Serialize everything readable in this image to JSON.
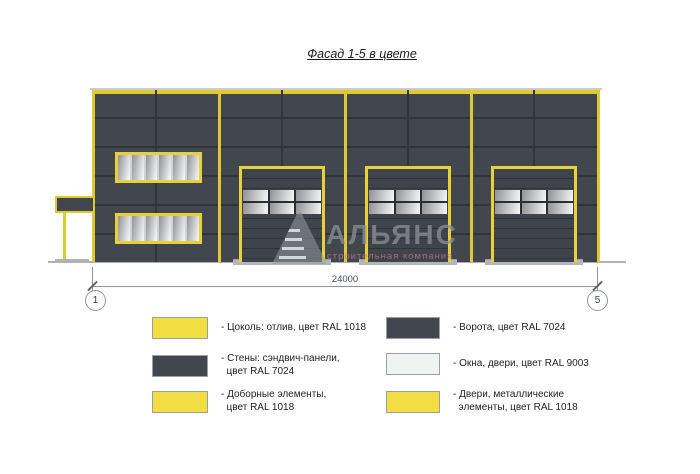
{
  "title": "Фасад 1-5 в цвете",
  "watermark": {
    "name": "АЛЬЯНС",
    "subtitle": "строительная компания"
  },
  "dimension": {
    "value": "24000",
    "axis_start": "1",
    "axis_end": "5"
  },
  "colors": {
    "ral_1018_yellow": "#f2dd42",
    "ral_7024_gray": "#42464e",
    "ral_9003_white": "#eef4ef",
    "wall_trim_yellow": "#e0ca32",
    "ground_gray": "#aeb1b4"
  },
  "legend": {
    "left": [
      {
        "swatch": "yellow",
        "label": "- Цоколь: отлив, цвет RAL 1018"
      },
      {
        "swatch": "dark",
        "label": "- Стены: сэндвич-панели,\n  цвет RAL 7024"
      },
      {
        "swatch": "yellow",
        "label": "- Доборные элементы,\n  цвет RAL 1018"
      }
    ],
    "right": [
      {
        "swatch": "dark",
        "label": "- Ворота, цвет RAL 7024"
      },
      {
        "swatch": "white",
        "label": "- Окна, двери, цвет RAL 9003"
      },
      {
        "swatch": "yellow",
        "label": "- Двери, металлические\n  элементы, цвет RAL 1018"
      }
    ]
  }
}
